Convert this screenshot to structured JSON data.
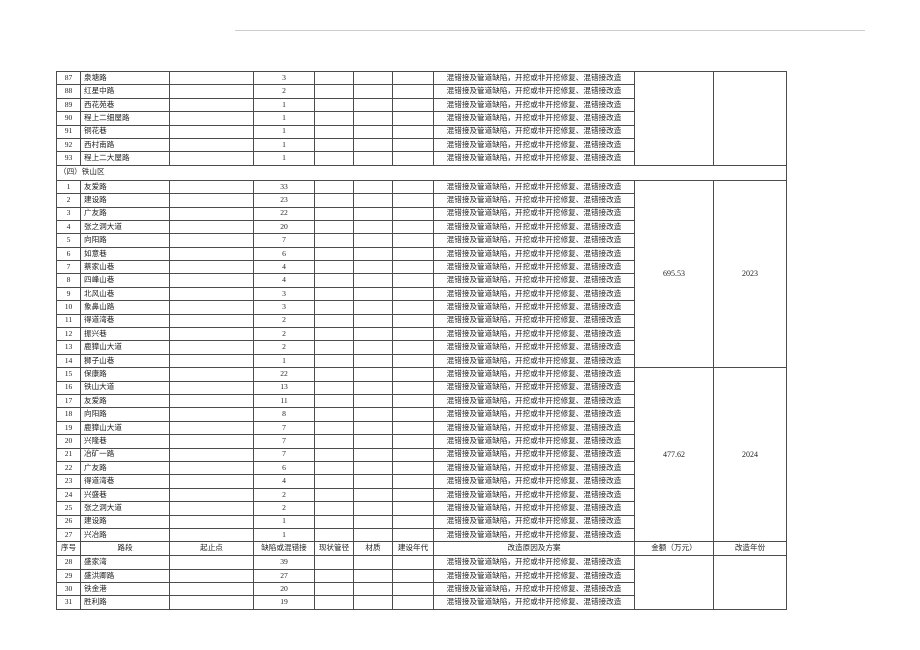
{
  "page": {
    "kind": "scanned-table-document",
    "background_color": "#ffffff",
    "border_color": "#4c4c4c",
    "text_color": "#1f1f1f"
  },
  "table": {
    "reason_text": "混错接及管道缺陷，开挖或非开挖修复、混错接改造",
    "columns": [
      {
        "key": "seq",
        "label": "序号",
        "width": 24
      },
      {
        "key": "road",
        "label": "路段",
        "width": 89
      },
      {
        "key": "startend",
        "label": "起止点",
        "width": 84
      },
      {
        "key": "defect",
        "label": "缺陷或混错接",
        "width": 61
      },
      {
        "key": "pipe",
        "label": "现状管径",
        "width": 39
      },
      {
        "key": "material",
        "label": "材质",
        "width": 39
      },
      {
        "key": "era",
        "label": "建设年代",
        "width": 41
      },
      {
        "key": "reason",
        "label": "改造原因及方案",
        "width": 201
      },
      {
        "key": "amount",
        "label": "金额（万元）",
        "width": 79
      },
      {
        "key": "year",
        "label": "改造年份",
        "width": 73
      }
    ],
    "groups": [
      {
        "type": "rows",
        "amount": "",
        "year": "",
        "rows": [
          {
            "seq": "87",
            "road": "泉塘路",
            "defect": "3"
          },
          {
            "seq": "88",
            "road": "红星中路",
            "defect": "2"
          },
          {
            "seq": "89",
            "road": "西花苑巷",
            "defect": "1"
          },
          {
            "seq": "90",
            "road": "程上二细屋路",
            "defect": "1"
          },
          {
            "seq": "91",
            "road": "铜花巷",
            "defect": "1"
          },
          {
            "seq": "92",
            "road": "西村南路",
            "defect": "1"
          },
          {
            "seq": "93",
            "road": "程上二大屋路",
            "defect": "1"
          }
        ]
      },
      {
        "type": "section",
        "label": "（四）铁山区"
      },
      {
        "type": "rows",
        "amount": "695.53",
        "year": "2023",
        "rows": [
          {
            "seq": "1",
            "road": "友爱路",
            "defect": "33"
          },
          {
            "seq": "2",
            "road": "建设路",
            "defect": "23"
          },
          {
            "seq": "3",
            "road": "广友路",
            "defect": "22"
          },
          {
            "seq": "4",
            "road": "张之洞大道",
            "defect": "20"
          },
          {
            "seq": "5",
            "road": "向阳路",
            "defect": "7"
          },
          {
            "seq": "6",
            "road": "如意巷",
            "defect": "6"
          },
          {
            "seq": "7",
            "road": "蔡家山巷",
            "defect": "4"
          },
          {
            "seq": "8",
            "road": "四峰山巷",
            "defect": "4"
          },
          {
            "seq": "9",
            "road": "北风山巷",
            "defect": "3"
          },
          {
            "seq": "10",
            "road": "象鼻山路",
            "defect": "3"
          },
          {
            "seq": "11",
            "road": "得道湾巷",
            "defect": "2"
          },
          {
            "seq": "12",
            "road": "振兴巷",
            "defect": "2"
          },
          {
            "seq": "13",
            "road": "鹿獐山大道",
            "defect": "2"
          },
          {
            "seq": "14",
            "road": "狮子山巷",
            "defect": "1"
          }
        ]
      },
      {
        "type": "rows",
        "amount": "477.62",
        "year": "2024",
        "rows": [
          {
            "seq": "15",
            "road": "保康路",
            "defect": "22"
          },
          {
            "seq": "16",
            "road": "铁山大道",
            "defect": "13"
          },
          {
            "seq": "17",
            "road": "友爱路",
            "defect": "11"
          },
          {
            "seq": "18",
            "road": "向阳路",
            "defect": "8"
          },
          {
            "seq": "19",
            "road": "鹿獐山大道",
            "defect": "7"
          },
          {
            "seq": "20",
            "road": "兴隆巷",
            "defect": "7"
          },
          {
            "seq": "21",
            "road": "冶矿一路",
            "defect": "7"
          },
          {
            "seq": "22",
            "road": "广友路",
            "defect": "6"
          },
          {
            "seq": "23",
            "road": "得道湾巷",
            "defect": "4"
          },
          {
            "seq": "24",
            "road": "兴盛巷",
            "defect": "2"
          },
          {
            "seq": "25",
            "road": "张之洞大道",
            "defect": "2"
          },
          {
            "seq": "26",
            "road": "建设路",
            "defect": "1"
          },
          {
            "seq": "27",
            "road": "兴冶路",
            "defect": "1"
          }
        ]
      },
      {
        "type": "header"
      },
      {
        "type": "rows",
        "amount": "",
        "year": "",
        "rows": [
          {
            "seq": "28",
            "road": "盛家湾",
            "defect": "39"
          },
          {
            "seq": "29",
            "road": "盛洪卿路",
            "defect": "27"
          },
          {
            "seq": "30",
            "road": "铁金港",
            "defect": "20"
          },
          {
            "seq": "31",
            "road": "胜利路",
            "defect": "19"
          }
        ]
      }
    ]
  }
}
